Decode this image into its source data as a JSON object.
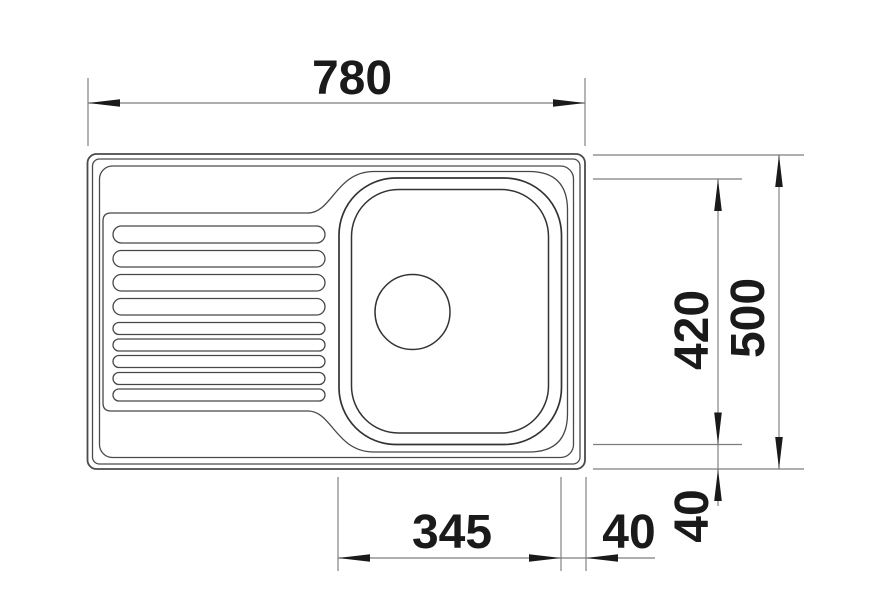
{
  "canvas": {
    "width": 874,
    "height": 608,
    "background": "#ffffff"
  },
  "colors": {
    "outline_stroke": "#4a4a4a",
    "bowl_stroke": "#333333",
    "dim_line": "#7d7d7d",
    "label": "#1a1a1a"
  },
  "dimensions": {
    "overall_width": "780",
    "overall_depth": "500",
    "cutout_depth": "420",
    "cutout_width": "345",
    "offset_right": "40",
    "offset_bottom": "40"
  }
}
